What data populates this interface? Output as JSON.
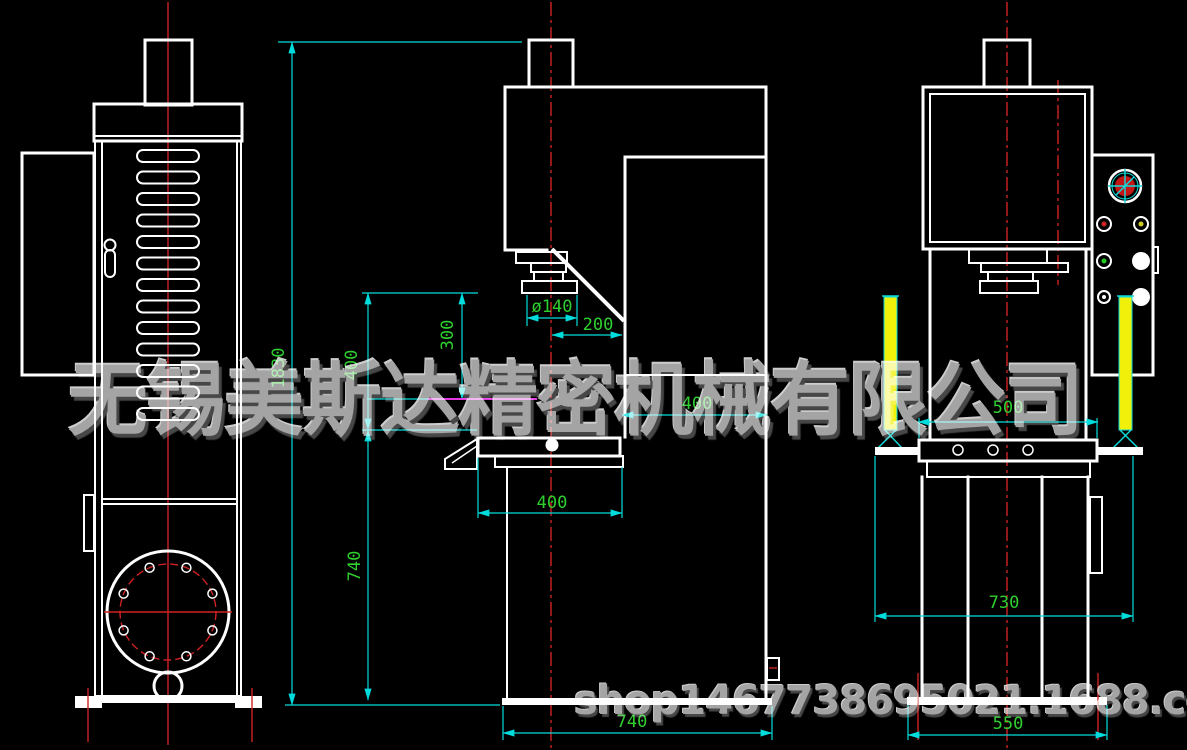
{
  "watermark": {
    "company": "无锡美斯达精密机械有限公司",
    "shop_url": "shop1467738695021.1688.com"
  },
  "dimensions": {
    "overall_height": "1830",
    "daylight_opening": "400",
    "stroke": "300",
    "table_height": "740",
    "ram_diameter": "ø140",
    "throat_centerline": "200",
    "column_depth": "400",
    "table_width": "400",
    "base_width_front": "740",
    "table_depth": "500",
    "guard_stand_span": "730",
    "base_depth_side": "550"
  },
  "colors": {
    "background": "#000000",
    "drawing_line": "#ffffff",
    "dimension_line": "#00dcdc",
    "dimension_text": "#2fcf2f",
    "centerline": "#cf2222",
    "light_curtain": "#f0f00a",
    "stroke_marker": "#e23ae2",
    "watermark": "#a4a4a4"
  }
}
